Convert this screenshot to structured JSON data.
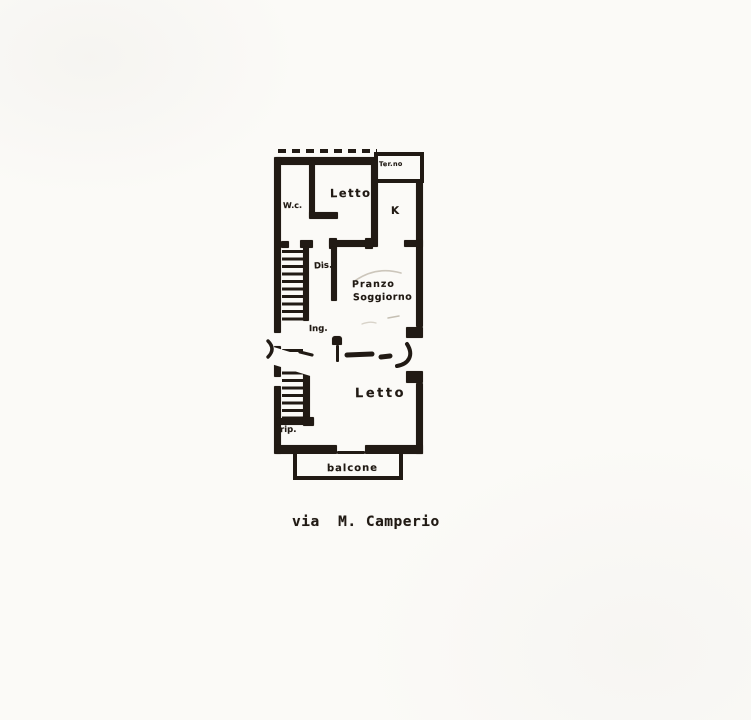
{
  "document": {
    "kind": "scanned floor plan",
    "caption": "via  M. Camperio",
    "labels": {
      "terrace": "Ter.no",
      "wc": "W.c.",
      "bedroom_top": "Letto",
      "kitchen": "K",
      "hall": "Dis.",
      "living_line1": "Pranzo",
      "living_line2": "Soggiorno",
      "entry": "Ing.",
      "bedroom_bottom": "Letto",
      "storage": "rip.",
      "balcony": "balcone"
    },
    "colors": {
      "paper": "#fbfaf7",
      "ink": "#211a14"
    }
  }
}
